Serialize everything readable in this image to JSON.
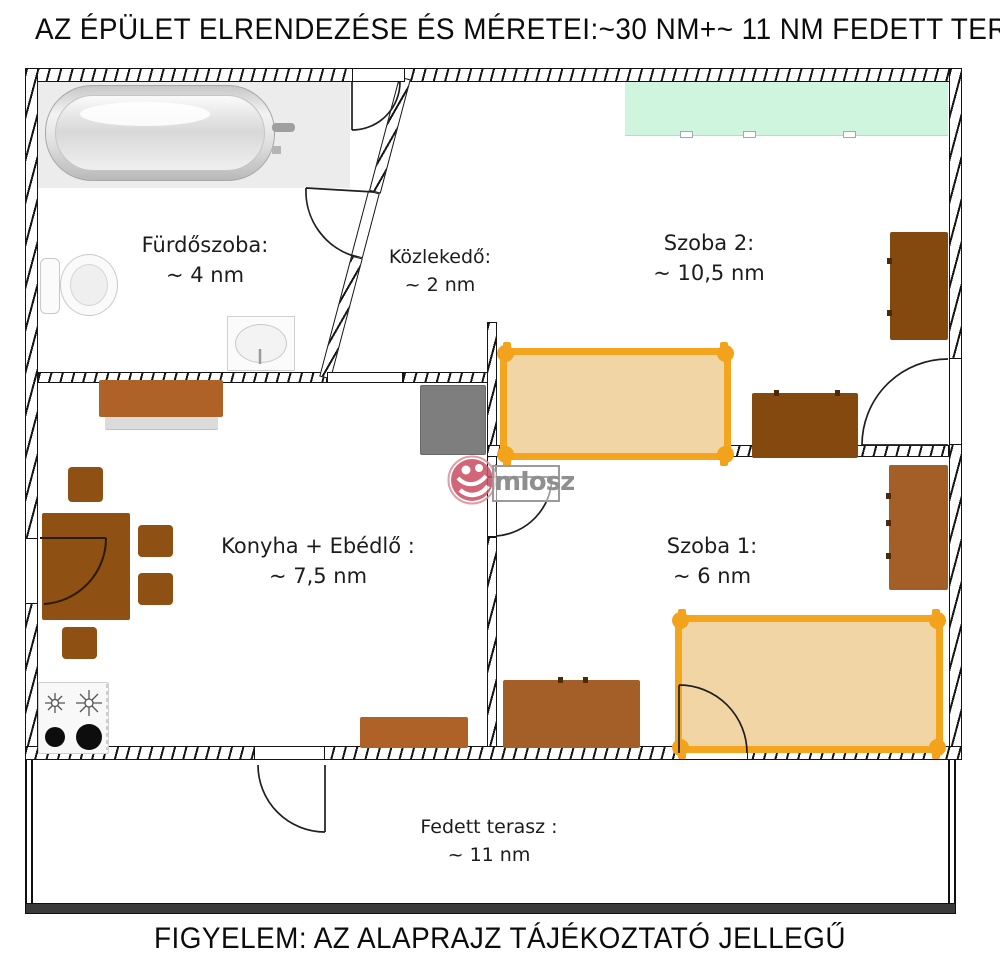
{
  "title": "AZ ÉPÜLET ELRENDEZÉSE ÉS MÉRETEI:~30 NM+~ 11 NM FEDETT TERASZ",
  "footer": "FIGYELEM: AZ ALAPRAJZ TÁJÉKOZTATÓ JELLEGŰ",
  "watermark": {
    "text": "mIosz",
    "logo": "miosz-logo",
    "logo_color": "#CB5166",
    "text_color": "#8f8f8f"
  },
  "rooms": [
    {
      "id": "furdoszoba",
      "name": "Fürdőszoba:",
      "size": "~ 4 nm"
    },
    {
      "id": "kozlekedo",
      "name": "Közlekedő:",
      "size": "~ 2 nm"
    },
    {
      "id": "szoba2",
      "name": "Szoba 2:",
      "size": "~ 10,5 nm"
    },
    {
      "id": "konyha",
      "name": "Konyha + Ebédlő :",
      "size": "~ 7,5 nm"
    },
    {
      "id": "szoba1",
      "name": "Szoba 1:",
      "size": "~ 6 nm"
    },
    {
      "id": "terasz",
      "name": "Fedett terasz :",
      "size": "~ 11 nm"
    }
  ],
  "colors": {
    "bed_frame": "#F3A51D",
    "bed_fill": "#F1D5A5",
    "dark_brown_furniture": "#84490F",
    "mid_brown_furniture": "#8E5013",
    "light_brown_furniture": "#A45E28",
    "kitchen_cabinet": "#AF6228",
    "wardrobe_green": "#CFF5DE",
    "fridge_gray": "#7E7E7E",
    "wall_line": "#141414",
    "label_text": "#1c1c1c"
  }
}
